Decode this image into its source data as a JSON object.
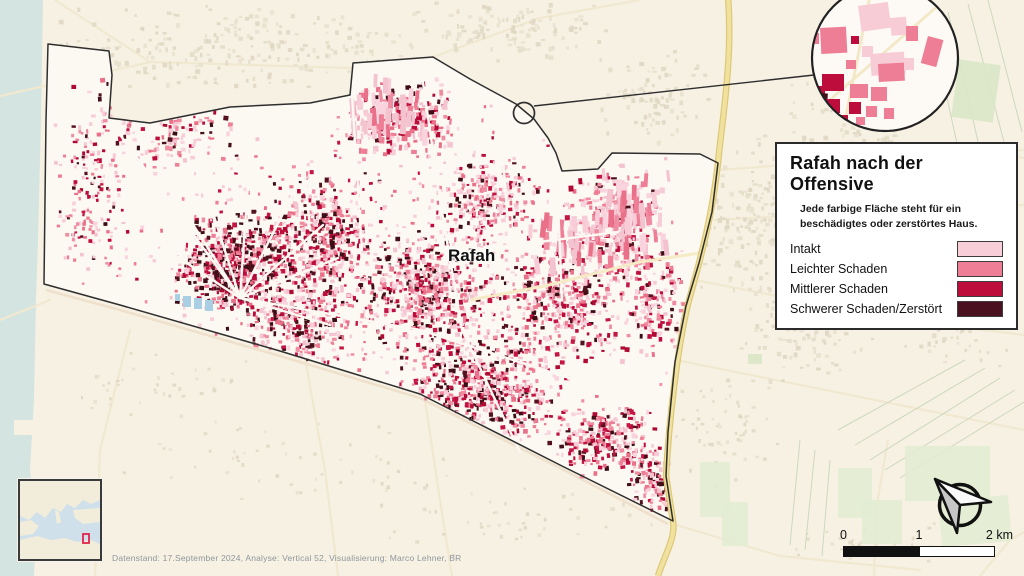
{
  "map_label": "Rafah",
  "attribution": "Datenstand: 17.September 2024, Analyse: Vertical 52, Visualisierung: Marco Lehner, BR",
  "legend": {
    "title": "Rafah nach der Offensive",
    "subtitle": "Jede farbige Fläche steht für ein beschädigtes oder zerstörtes Haus.",
    "items": [
      {
        "label": "Intakt",
        "color": "#f8cfd9"
      },
      {
        "label": "Leichter Schaden",
        "color": "#ee7e95"
      },
      {
        "label": "Mittlerer Schaden",
        "color": "#bd0d3c"
      },
      {
        "label": "Schwerer Schaden/Zerstört",
        "color": "#4a1220"
      }
    ]
  },
  "scalebar": {
    "start": "0",
    "mid": "1",
    "end": "2 km"
  },
  "colors": {
    "bg_outside": "#f7f1e4",
    "bg_inside": "#fcf8f2",
    "water": "#d4e4e1",
    "boundary": "#2e2e2e",
    "road_faint": "#f1e8d0",
    "road_sand": "#eee0cb",
    "road_yellow": "#f0e19e",
    "road_yellow_edge": "#dcc775",
    "pond": "#a9cfe4",
    "green": "#d9e7c7",
    "green_light": "#e2ecd3",
    "field_line": "#ccd8bd",
    "beige": [
      "#e7e0ce",
      "#ded6c1",
      "#e2dac6"
    ],
    "class_i": [
      "#f7ccd7",
      "#f4c3d0",
      "#f9d4de"
    ],
    "class_l": [
      "#ee7e95",
      "#f08ca1",
      "#ea7089"
    ],
    "class_m": [
      "#bd0d3c",
      "#c41544",
      "#b00a34"
    ],
    "class_s": [
      "#451019",
      "#54121f",
      "#3c0d15"
    ]
  },
  "geometry": {
    "boundary": [
      [
        48,
        44
      ],
      [
        109,
        51
      ],
      [
        112,
        75
      ],
      [
        109,
        118
      ],
      [
        150,
        123
      ],
      [
        230,
        107
      ],
      [
        310,
        103
      ],
      [
        350,
        95
      ],
      [
        353,
        63
      ],
      [
        433,
        57
      ],
      [
        470,
        79
      ],
      [
        516,
        104
      ],
      [
        534,
        119
      ],
      [
        548,
        138
      ],
      [
        556,
        153
      ],
      [
        562,
        171
      ],
      [
        598,
        169
      ],
      [
        612,
        153
      ],
      [
        700,
        154
      ],
      [
        718,
        163
      ],
      [
        712,
        212
      ],
      [
        699,
        263
      ],
      [
        686,
        306
      ],
      [
        675,
        362
      ],
      [
        668,
        432
      ],
      [
        666,
        476
      ],
      [
        673,
        521
      ],
      [
        560,
        465
      ],
      [
        420,
        394
      ],
      [
        280,
        351
      ],
      [
        120,
        305
      ],
      [
        44,
        284
      ],
      [
        45,
        200
      ],
      [
        46,
        120
      ]
    ],
    "water": [
      [
        0,
        0
      ],
      [
        43,
        0
      ],
      [
        41,
        120
      ],
      [
        38,
        240
      ],
      [
        36,
        300
      ],
      [
        34,
        400
      ],
      [
        30,
        470
      ],
      [
        36,
        530
      ],
      [
        34,
        576
      ],
      [
        0,
        576
      ]
    ],
    "pier": [
      14,
      420,
      24,
      15
    ],
    "roads_faint": [
      [
        [
          0,
          96
        ],
        [
          150,
          62
        ],
        [
          352,
          68
        ]
      ],
      [
        [
          55,
          0
        ],
        [
          150,
          62
        ]
      ],
      [
        [
          433,
          57
        ],
        [
          540,
          18
        ],
        [
          640,
          0
        ]
      ],
      [
        [
          718,
          170
        ],
        [
          880,
          158
        ],
        [
          1024,
          150
        ]
      ],
      [
        [
          714,
          220
        ],
        [
          900,
          210
        ],
        [
          1024,
          205
        ]
      ],
      [
        [
          695,
          280
        ],
        [
          900,
          320
        ],
        [
          1024,
          335
        ]
      ],
      [
        [
          676,
          360
        ],
        [
          850,
          395
        ],
        [
          1024,
          430
        ]
      ],
      [
        [
          50,
          300
        ],
        [
          0,
          320
        ]
      ],
      [
        [
          130,
          330
        ],
        [
          100,
          450
        ],
        [
          95,
          576
        ]
      ],
      [
        [
          305,
          358
        ],
        [
          325,
          470
        ],
        [
          338,
          576
        ]
      ],
      [
        [
          425,
          400
        ],
        [
          440,
          500
        ],
        [
          452,
          576
        ]
      ],
      [
        [
          673,
          524
        ],
        [
          780,
          556
        ],
        [
          920,
          570
        ]
      ],
      [
        [
          888,
          440
        ],
        [
          876,
          510
        ],
        [
          874,
          576
        ]
      ],
      [
        [
          980,
          576
        ],
        [
          1010,
          540
        ],
        [
          1024,
          532
        ]
      ],
      [
        [
          955,
          148
        ],
        [
          1024,
          158
        ]
      ]
    ],
    "road_sand": [
      [
        46,
        290
      ],
      [
        120,
        310
      ],
      [
        280,
        356
      ],
      [
        420,
        398
      ],
      [
        560,
        468
      ],
      [
        668,
        524
      ]
    ],
    "highway": "M728,-4 C733,60 722,120 718,163 C712,215 703,250 688,304 C678,345 669,420 666,476 L673,521 C676,538 664,556 658,576",
    "streets": [
      [
        240,
        298,
        176,
        198
      ],
      [
        240,
        298,
        205,
        188
      ],
      [
        240,
        298,
        248,
        183
      ],
      [
        240,
        298,
        292,
        196
      ],
      [
        240,
        298,
        323,
        225
      ],
      [
        240,
        298,
        338,
        258
      ],
      [
        170,
        252,
        240,
        298
      ],
      [
        240,
        298,
        330,
        325
      ],
      [
        118,
        132,
        240,
        298
      ],
      [
        240,
        298,
        420,
        330
      ],
      [
        420,
        330,
        600,
        388
      ],
      [
        420,
        62,
        440,
        200
      ],
      [
        440,
        200,
        462,
        330
      ],
      [
        462,
        330,
        520,
        452
      ],
      [
        352,
        95,
        362,
        250
      ],
      [
        556,
        154,
        562,
        300
      ],
      [
        460,
        252,
        618,
        232
      ],
      [
        500,
        120,
        510,
        250
      ],
      [
        300,
        120,
        310,
        230
      ]
    ],
    "interior_road": [
      [
        470,
        300
      ],
      [
        545,
        286
      ],
      [
        640,
        262
      ],
      [
        700,
        253
      ]
    ],
    "greens": [
      [
        955,
        62,
        42,
        58,
        8,
        "g1"
      ],
      [
        905,
        446,
        85,
        55,
        0,
        "g2"
      ],
      [
        940,
        498,
        70,
        46,
        -5,
        "g2"
      ],
      [
        838,
        468,
        34,
        50,
        0,
        "g2"
      ],
      [
        862,
        500,
        40,
        44,
        0,
        "g2"
      ],
      [
        700,
        462,
        30,
        55,
        0,
        "g2"
      ],
      [
        722,
        502,
        26,
        44,
        0,
        "g2"
      ],
      [
        748,
        354,
        14,
        10,
        0,
        "g1"
      ],
      [
        195,
        276,
        14,
        8,
        0,
        "g1"
      ],
      [
        352,
        300,
        12,
        8,
        0,
        "g1"
      ]
    ],
    "green_lines": [
      [
        948,
        12,
        980,
        150
      ],
      [
        968,
        4,
        1004,
        142
      ],
      [
        988,
        0,
        1022,
        132
      ],
      [
        930,
        20,
        958,
        148
      ],
      [
        838,
        430,
        965,
        360
      ],
      [
        855,
        445,
        985,
        368
      ],
      [
        870,
        460,
        1000,
        378
      ],
      [
        885,
        470,
        1015,
        390
      ],
      [
        900,
        478,
        1024,
        402
      ],
      [
        800,
        440,
        790,
        545
      ],
      [
        815,
        450,
        805,
        550
      ],
      [
        830,
        460,
        822,
        556
      ]
    ],
    "ponds": [
      [
        183,
        296,
        8,
        11
      ],
      [
        194,
        298,
        8,
        11
      ],
      [
        205,
        300,
        8,
        11
      ],
      [
        175,
        294,
        5,
        7
      ]
    ]
  },
  "clusters": {
    "inside": [
      [
        150,
        118,
        95,
        58,
        240,
        2,
        5,
        [
          0.42,
          0.3,
          0.18,
          0.1
        ],
        0
      ],
      [
        88,
        200,
        38,
        85,
        140,
        2,
        4,
        [
          0.4,
          0.3,
          0.2,
          0.1
        ],
        0
      ],
      [
        235,
        262,
        62,
        55,
        620,
        2,
        5,
        [
          0.1,
          0.26,
          0.3,
          0.34
        ],
        0
      ],
      [
        320,
        238,
        55,
        72,
        400,
        2,
        5,
        [
          0.24,
          0.34,
          0.26,
          0.16
        ],
        0
      ],
      [
        398,
        116,
        62,
        40,
        280,
        2,
        6,
        [
          0.45,
          0.3,
          0.15,
          0.1
        ],
        0
      ],
      [
        300,
        320,
        58,
        48,
        280,
        2,
        5,
        [
          0.3,
          0.3,
          0.24,
          0.16
        ],
        0
      ],
      [
        422,
        290,
        75,
        62,
        520,
        2,
        5,
        [
          0.3,
          0.3,
          0.22,
          0.18
        ],
        0
      ],
      [
        480,
        388,
        88,
        55,
        560,
        2,
        5,
        [
          0.24,
          0.3,
          0.26,
          0.2
        ],
        0
      ],
      [
        560,
        300,
        70,
        68,
        400,
        2,
        5,
        [
          0.36,
          0.3,
          0.2,
          0.14
        ],
        0
      ],
      [
        612,
        218,
        52,
        58,
        260,
        2,
        6,
        [
          0.5,
          0.3,
          0.12,
          0.08
        ],
        0
      ],
      [
        650,
        300,
        38,
        58,
        170,
        2,
        5,
        [
          0.4,
          0.3,
          0.2,
          0.1
        ],
        0
      ],
      [
        600,
        438,
        55,
        40,
        260,
        2,
        5,
        [
          0.3,
          0.3,
          0.25,
          0.15
        ],
        0
      ],
      [
        652,
        478,
        26,
        38,
        120,
        2,
        5,
        [
          0.35,
          0.3,
          0.2,
          0.15
        ],
        0
      ],
      [
        480,
        200,
        58,
        48,
        230,
        2,
        5,
        [
          0.4,
          0.3,
          0.2,
          0.1
        ],
        0
      ],
      [
        380,
        280,
        330,
        205,
        650,
        2,
        4,
        [
          0.5,
          0.3,
          0.13,
          0.07
        ],
        0
      ],
      [
        625,
        212,
        52,
        50,
        55,
        3,
        6,
        [
          0.6,
          0.4,
          0,
          0
        ],
        1
      ],
      [
        385,
        103,
        48,
        33,
        36,
        3,
        6,
        [
          0.7,
          0.3,
          0,
          0
        ],
        1
      ],
      [
        560,
        240,
        40,
        40,
        30,
        3,
        6,
        [
          0.6,
          0.4,
          0,
          0
        ],
        1
      ]
    ],
    "outside": [
      [
        250,
        45,
        215,
        45,
        240,
        2,
        5
      ],
      [
        520,
        28,
        95,
        32,
        110,
        2,
        5
      ],
      [
        648,
        95,
        60,
        48,
        90,
        2,
        5
      ],
      [
        760,
        215,
        70,
        85,
        200,
        2,
        5
      ],
      [
        850,
        118,
        70,
        48,
        90,
        2,
        5
      ],
      [
        795,
        325,
        60,
        60,
        110,
        2,
        5
      ],
      [
        880,
        300,
        80,
        55,
        80,
        2,
        5
      ],
      [
        925,
        205,
        55,
        50,
        60,
        2,
        5
      ],
      [
        300,
        462,
        185,
        48,
        55,
        2,
        4
      ],
      [
        150,
        385,
        100,
        40,
        40,
        2,
        4
      ],
      [
        520,
        520,
        150,
        38,
        45,
        2,
        4
      ],
      [
        855,
        540,
        85,
        25,
        35,
        2,
        4
      ],
      [
        985,
        255,
        35,
        80,
        50,
        2,
        4
      ],
      [
        730,
        430,
        60,
        60,
        60,
        2,
        4
      ],
      [
        960,
        330,
        50,
        40,
        40,
        2,
        4
      ]
    ]
  },
  "magnifier": {
    "cx": 885,
    "cy": 58,
    "r": 73,
    "small_cx": 524,
    "small_cy": 113,
    "small_r": 10.5,
    "connector": [
      534,
      106,
      814,
      75
    ],
    "roads": [
      [
        816,
        112,
        940,
        4
      ],
      [
        843,
        131,
        872,
        -14
      ]
    ],
    "buildings": [
      [
        858,
        6,
        30,
        26,
        -8,
        "i"
      ],
      [
        890,
        18,
        16,
        18,
        -5,
        "i"
      ],
      [
        906,
        26,
        12,
        15,
        0,
        "l"
      ],
      [
        820,
        28,
        26,
        26,
        -3,
        "l"
      ],
      [
        810,
        33,
        9,
        11,
        0,
        "l"
      ],
      [
        851,
        36,
        8,
        8,
        0,
        "m"
      ],
      [
        862,
        46,
        11,
        11,
        0,
        "i"
      ],
      [
        870,
        54,
        34,
        22,
        -4,
        "i"
      ],
      [
        878,
        64,
        26,
        18,
        -3,
        "l"
      ],
      [
        846,
        60,
        10,
        9,
        0,
        "l"
      ],
      [
        822,
        74,
        22,
        17,
        0,
        "m"
      ],
      [
        812,
        86,
        13,
        14,
        0,
        "m"
      ],
      [
        810,
        92,
        18,
        16,
        5,
        "s"
      ],
      [
        826,
        99,
        14,
        14,
        0,
        "m"
      ],
      [
        850,
        84,
        18,
        14,
        0,
        "l"
      ],
      [
        871,
        87,
        16,
        14,
        0,
        "l"
      ],
      [
        849,
        102,
        12,
        12,
        0,
        "m"
      ],
      [
        866,
        106,
        11,
        11,
        0,
        "l"
      ],
      [
        884,
        108,
        10,
        11,
        0,
        "l"
      ],
      [
        928,
        36,
        16,
        28,
        15,
        "l"
      ],
      [
        904,
        58,
        10,
        12,
        0,
        "i"
      ],
      [
        838,
        115,
        10,
        9,
        0,
        "m"
      ],
      [
        856,
        117,
        9,
        8,
        0,
        "l"
      ]
    ]
  }
}
